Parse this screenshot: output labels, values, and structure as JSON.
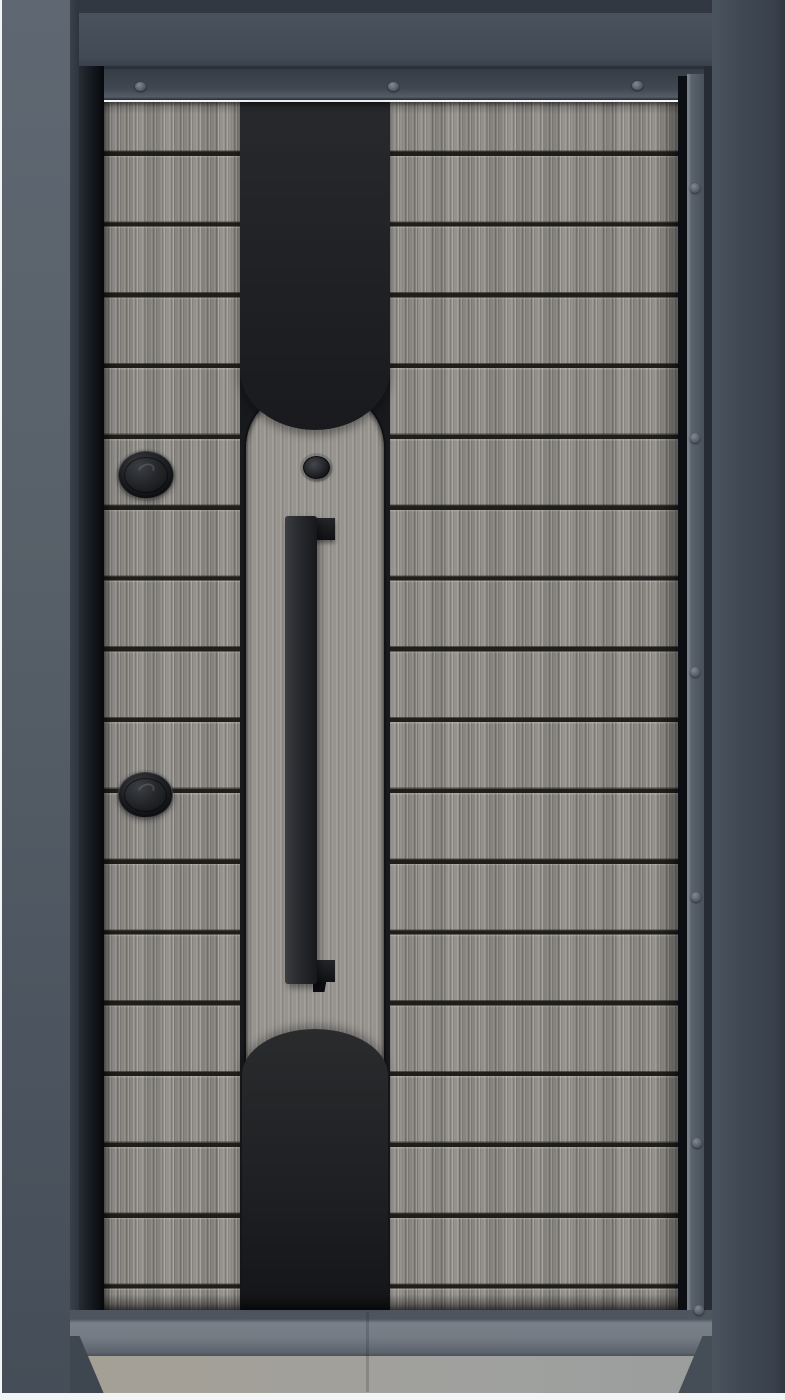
{
  "scene": {
    "type": "photograph",
    "subject": "Modern anthracite steel security entry door with grey wood-grain laminate leaf",
    "setting": "dark grey metal door frame standing on a concrete floor with a light threshold"
  },
  "door": {
    "leaf_finish": "grey wood-grain laminate, horizontal plank grooves",
    "groove_count": 17,
    "center_stripe": {
      "shape": "full-height vertical band with rounded black cap at top and rounded black dome at bottom",
      "finish": "matte black"
    },
    "center_plank": {
      "finish": "grey wood-grain laminate, vertical grain, rounded corners",
      "contains": [
        "cylinder knob",
        "vertical pull handle"
      ]
    },
    "handle": {
      "type": "long vertical pull bar with two mounting brackets",
      "finish": "matte black"
    },
    "cylinder_knob": {
      "type": "small round black knob above handle"
    },
    "keyhole_covers": [
      {
        "position": "upper left side of leaf",
        "shape": "black oval swivel cap"
      },
      {
        "position": "lower left side of leaf",
        "shape": "black oval swivel cap"
      }
    ]
  },
  "frame": {
    "finish": "anthracite grey powder-coated steel",
    "top_bevel_screws": 3,
    "right_bevel_screws": 6
  },
  "floor": {
    "threshold": "grey aluminium sill",
    "surface": "light grey concrete / stone"
  },
  "colors": {
    "bg_white": "#f3f4f5",
    "frame_top": "#49525d",
    "frame_col": "#3e4752",
    "frame_edge": "#313842",
    "pillar_hi": "#5f6772",
    "bevel": "#3f4751",
    "bevel_right": "#5b636d",
    "recess": "#14171c",
    "wood": "#8f8c88",
    "wood_light": "#a5a29d",
    "wood_dark": "#78756f",
    "groove": "#1f1e1b",
    "panel": "#979490",
    "panel_light": "#adaaa5",
    "panel_dark": "#83807c",
    "black_band": "#1f2023",
    "stripe_gap": "#17191c",
    "handle": "#212326",
    "sill": "#747b84",
    "floor": "#9fa19f",
    "floor_warm": "#a5a096"
  }
}
